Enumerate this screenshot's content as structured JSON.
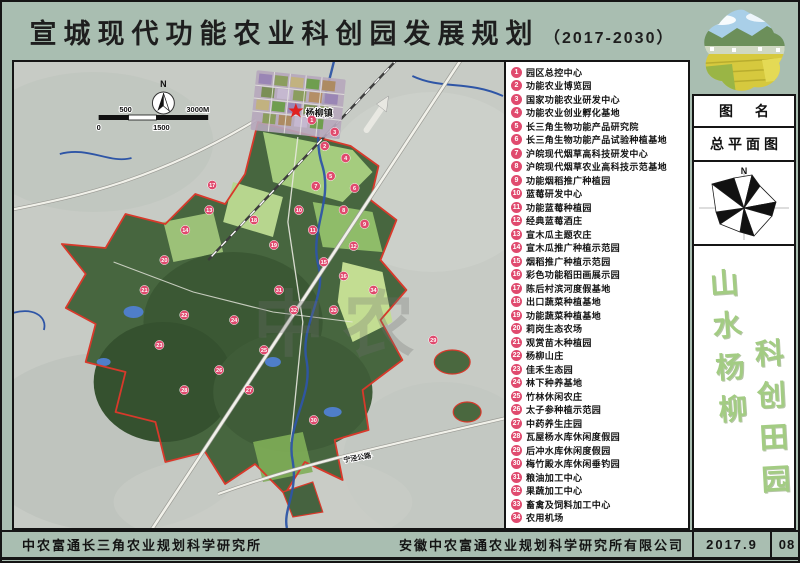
{
  "title": {
    "main": "宣城现代功能农业科创园发展规划",
    "period": "（2017-2030）"
  },
  "legend": {
    "items": [
      {
        "num": "1",
        "label": "园区总控中心"
      },
      {
        "num": "2",
        "label": "功能农业博览园"
      },
      {
        "num": "3",
        "label": "国家功能农业研发中心"
      },
      {
        "num": "4",
        "label": "功能农业创业孵化基地"
      },
      {
        "num": "5",
        "label": "长三角生物功能产品研究院"
      },
      {
        "num": "6",
        "label": "长三角生物功能产品试验种植基地"
      },
      {
        "num": "7",
        "label": "沪皖现代烟草高科技研发中心"
      },
      {
        "num": "8",
        "label": "沪皖现代烟草农业高科技示范基地"
      },
      {
        "num": "9",
        "label": "功能烟稻推广种植园"
      },
      {
        "num": "10",
        "label": "蓝莓研发中心"
      },
      {
        "num": "11",
        "label": "功能蓝莓种植园"
      },
      {
        "num": "12",
        "label": "经典蓝莓酒庄"
      },
      {
        "num": "13",
        "label": "宣木瓜主题农庄"
      },
      {
        "num": "14",
        "label": "宣木瓜推广种植示范园"
      },
      {
        "num": "15",
        "label": "烟稻推广种植示范园"
      },
      {
        "num": "16",
        "label": "彩色功能稻田画展示园"
      },
      {
        "num": "17",
        "label": "陈后村滨河度假基地"
      },
      {
        "num": "18",
        "label": "出口蔬菜种植基地"
      },
      {
        "num": "19",
        "label": "功能蔬菜种植基地"
      },
      {
        "num": "20",
        "label": "莉岗生态农场"
      },
      {
        "num": "21",
        "label": "观赏苗木种植园"
      },
      {
        "num": "22",
        "label": "杨柳山庄"
      },
      {
        "num": "23",
        "label": "佳禾生态园"
      },
      {
        "num": "24",
        "label": "林下种养基地"
      },
      {
        "num": "25",
        "label": "竹林休闲农庄"
      },
      {
        "num": "26",
        "label": "太子参种植示范园"
      },
      {
        "num": "27",
        "label": "中药养生庄园"
      },
      {
        "num": "28",
        "label": "瓦屋杨水库休闲度假园"
      },
      {
        "num": "29",
        "label": "后冲水库休闲度假园"
      },
      {
        "num": "30",
        "label": "梅竹殿水库休闲垂钓园"
      },
      {
        "num": "31",
        "label": "粮油加工中心"
      },
      {
        "num": "32",
        "label": "果蔬加工中心"
      },
      {
        "num": "33",
        "label": "畜禽及饲料加工中心"
      },
      {
        "num": "34",
        "label": "农用机场"
      }
    ]
  },
  "map": {
    "north": "N",
    "scale": {
      "s500": "500",
      "s3000": "3000M",
      "s0": "0",
      "s1500": "1500"
    },
    "town": "杨柳镇",
    "road": "宁泾公路",
    "watermark": "中农",
    "markers": [
      {
        "n": "1",
        "x": 299,
        "y": 58
      },
      {
        "n": "2",
        "x": 312,
        "y": 84
      },
      {
        "n": "3",
        "x": 322,
        "y": 70
      },
      {
        "n": "4",
        "x": 333,
        "y": 96
      },
      {
        "n": "5",
        "x": 318,
        "y": 114
      },
      {
        "n": "6",
        "x": 342,
        "y": 126
      },
      {
        "n": "7",
        "x": 303,
        "y": 124
      },
      {
        "n": "8",
        "x": 331,
        "y": 148
      },
      {
        "n": "9",
        "x": 352,
        "y": 162
      },
      {
        "n": "10",
        "x": 286,
        "y": 148
      },
      {
        "n": "11",
        "x": 300,
        "y": 168
      },
      {
        "n": "12",
        "x": 341,
        "y": 184
      },
      {
        "n": "13",
        "x": 196,
        "y": 148
      },
      {
        "n": "14",
        "x": 172,
        "y": 168
      },
      {
        "n": "15",
        "x": 311,
        "y": 200
      },
      {
        "n": "16",
        "x": 331,
        "y": 214
      },
      {
        "n": "17",
        "x": 199,
        "y": 123
      },
      {
        "n": "18",
        "x": 241,
        "y": 158
      },
      {
        "n": "19",
        "x": 261,
        "y": 183
      },
      {
        "n": "20",
        "x": 151,
        "y": 198
      },
      {
        "n": "21",
        "x": 131,
        "y": 228
      },
      {
        "n": "22",
        "x": 171,
        "y": 253
      },
      {
        "n": "23",
        "x": 146,
        "y": 283
      },
      {
        "n": "24",
        "x": 221,
        "y": 258
      },
      {
        "n": "25",
        "x": 251,
        "y": 288
      },
      {
        "n": "26",
        "x": 206,
        "y": 308
      },
      {
        "n": "27",
        "x": 236,
        "y": 328
      },
      {
        "n": "28",
        "x": 171,
        "y": 328
      },
      {
        "n": "29",
        "x": 421,
        "y": 278
      },
      {
        "n": "30",
        "x": 301,
        "y": 358
      },
      {
        "n": "31",
        "x": 266,
        "y": 228
      },
      {
        "n": "32",
        "x": 281,
        "y": 248
      },
      {
        "n": "33",
        "x": 321,
        "y": 248
      },
      {
        "n": "34",
        "x": 361,
        "y": 228
      }
    ]
  },
  "panel": {
    "tuming": "图 名",
    "plan_name": "总平面图",
    "compass_n": "N",
    "calligraphy_left": "山水杨柳",
    "calligraphy_right": "科创田园"
  },
  "footer": {
    "left_org": "中农富通长三角农业规划科学研究所",
    "right_org": "安徽中农富通农业规划科学研究所有限公司",
    "date": "2017.9",
    "sheet": "08"
  },
  "colors": {
    "frame_green": "#a9beb1",
    "badge_pink": "#e04a6e",
    "park_green": "#47663f",
    "boundary_red": "#d8392b",
    "river_blue": "#2e55a6",
    "calligraphy_green": "#a3cc83"
  }
}
